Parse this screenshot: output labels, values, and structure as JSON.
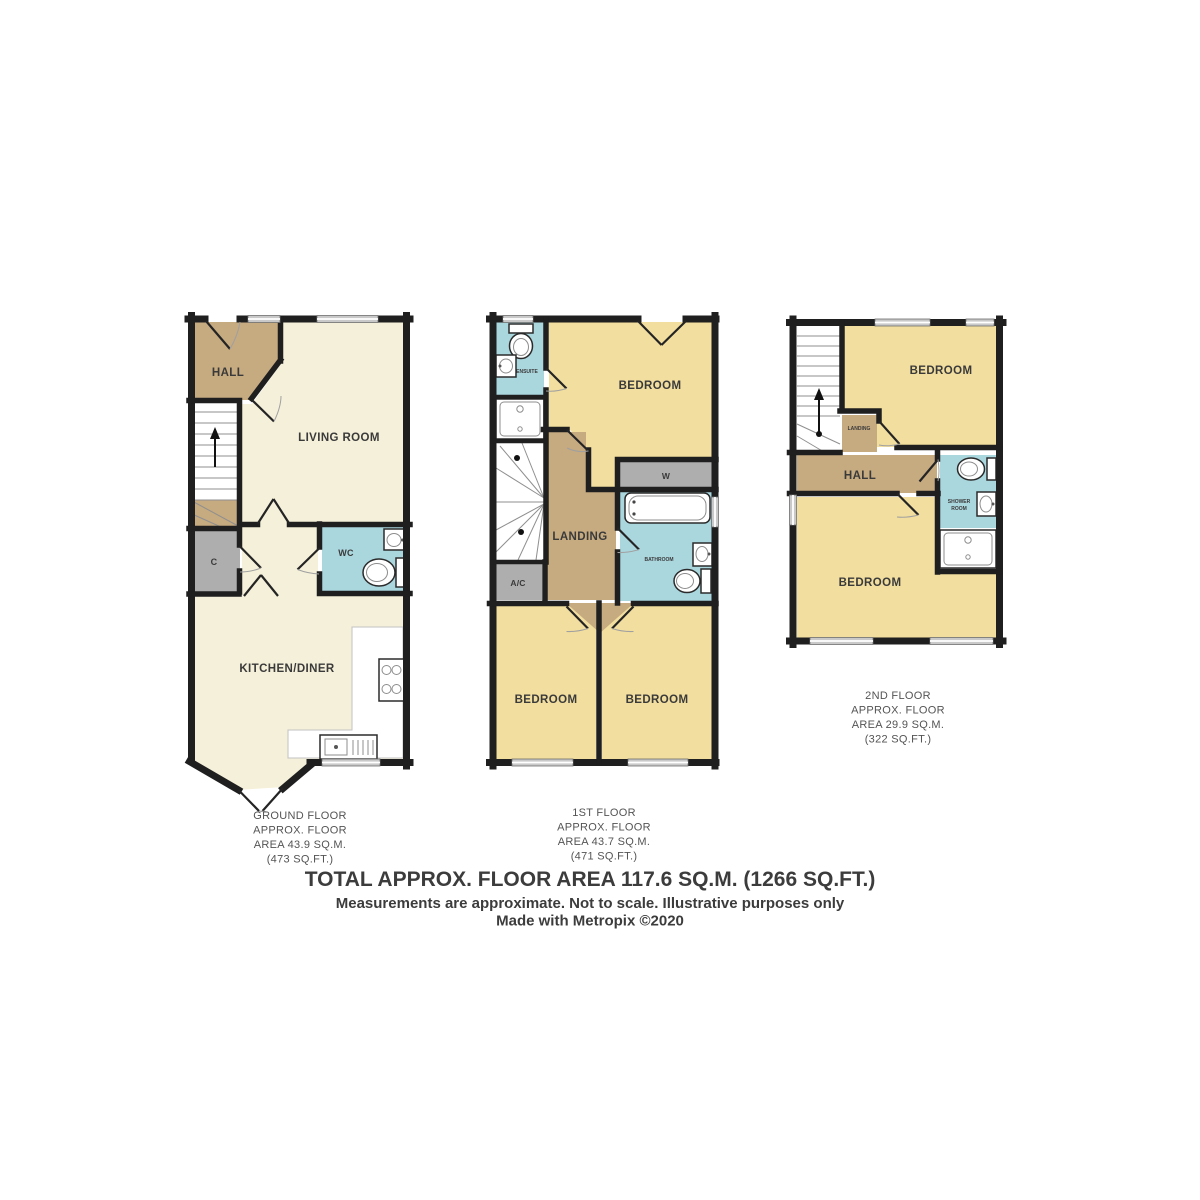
{
  "plans": {
    "ground": {
      "rooms": {
        "hall": "HALL",
        "living_room": "LIVING ROOM",
        "cupboard": "C",
        "wc": "WC",
        "kitchen_diner": "KITCHEN/DINER"
      },
      "caption": [
        "GROUND FLOOR",
        "APPROX. FLOOR",
        "AREA 43.9 SQ.M.",
        "(473 SQ.FT.)"
      ]
    },
    "first": {
      "rooms": {
        "ensuite": "ENSUITE",
        "bedroom": "BEDROOM",
        "wardrobe": "W",
        "landing": "LANDING",
        "bathroom": "BATHROOM",
        "airing_cupboard": "A/C",
        "bedroom2": "BEDROOM",
        "bedroom3": "BEDROOM"
      },
      "caption": [
        "1ST FLOOR",
        "APPROX. FLOOR",
        "AREA 43.7 SQ.M.",
        "(471 SQ.FT.)"
      ]
    },
    "second": {
      "rooms": {
        "bedroom": "BEDROOM",
        "landing": "LANDING",
        "hall": "HALL",
        "shower_room_lines": [
          "SHOWER",
          "ROOM"
        ],
        "bedroom2": "BEDROOM"
      },
      "caption": [
        "2ND FLOOR",
        "APPROX. FLOOR",
        "AREA 29.9 SQ.M.",
        "(322 SQ.FT.)"
      ]
    }
  },
  "footer": {
    "total": "TOTAL APPROX. FLOOR AREA 117.6 SQ.M. (1266 SQ.FT.)",
    "disclaimer": "Measurements are approximate.  Not to scale.  Illustrative purposes only",
    "credit": "Made with Metropix ©2020"
  },
  "colors": {
    "wall": "#1f1f1f",
    "bedroom_yellow": "#F2DE9E",
    "cream": "#F5F0D9",
    "tan": "#C6AA80",
    "bathroom_blue": "#AAD6DE",
    "cupboard_grey": "#AEAEAE",
    "window_grey": "#C9C9C9",
    "label": "#3a3a3a",
    "caption": "#545454",
    "footer": "#3c3c3c"
  }
}
